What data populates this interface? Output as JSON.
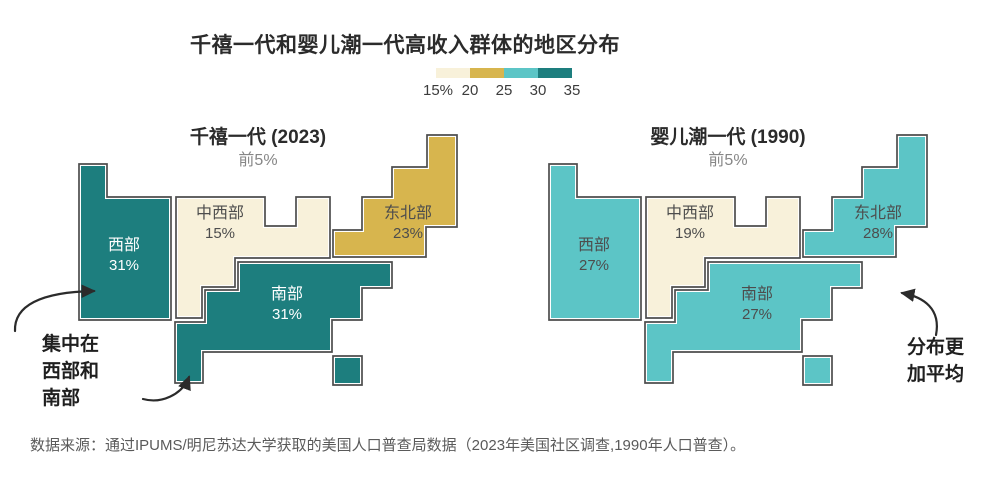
{
  "title": "千禧一代和婴儿潮一代高收入群体的地区分布",
  "colors": {
    "cream": "#f8f1da",
    "gold": "#d7b54e",
    "teal_light": "#5cc5c6",
    "teal_dark": "#1d7e7e",
    "outline": "#4d4d4d"
  },
  "legend": {
    "tick_labels": [
      "15%",
      "20",
      "25",
      "30",
      "35"
    ],
    "colors": [
      "#f8f1da",
      "#d7b54e",
      "#5cc5c6",
      "#1d7e7e"
    ]
  },
  "panels": [
    {
      "title": "千禧一代 (2023)",
      "subtitle": "前5%",
      "regions": {
        "west": {
          "name": "西部",
          "value": "31%"
        },
        "midwest": {
          "name": "中西部",
          "value": "15%"
        },
        "northeast": {
          "name": "东北部",
          "value": "23%"
        },
        "south": {
          "name": "南部",
          "value": "31%"
        }
      },
      "region_colors": {
        "west": "#1d7e7e",
        "midwest": "#f8f1da",
        "northeast": "#d7b54e",
        "south": "#1d7e7e"
      }
    },
    {
      "title": "婴儿潮一代 (1990)",
      "subtitle": "前5%",
      "regions": {
        "west": {
          "name": "西部",
          "value": "27%"
        },
        "midwest": {
          "name": "中西部",
          "value": "19%"
        },
        "northeast": {
          "name": "东北部",
          "value": "28%"
        },
        "south": {
          "name": "南部",
          "value": "27%"
        }
      },
      "region_colors": {
        "west": "#5cc5c6",
        "midwest": "#f8f1da",
        "northeast": "#5cc5c6",
        "south": "#5cc5c6"
      }
    }
  ],
  "annotations": {
    "left": {
      "lines": [
        "集中在",
        "西部和",
        "南部"
      ]
    },
    "right": {
      "lines": [
        "分布更",
        "加平均"
      ]
    }
  },
  "source": "数据来源：通过IPUMS/明尼苏达大学获取的美国人口普查局数据（2023年美国社区调查,1990年人口普查）。",
  "chart_data": {
    "type": "choropleth",
    "subtype": "block-cartogram, two side-by-side US region maps",
    "unit": "%",
    "title": "千禧一代和婴儿潮一代高收入群体的地区分布",
    "color_scale": {
      "tick_labels": [
        "15%",
        "20",
        "25",
        "30",
        "35"
      ],
      "bins": [
        "15-20",
        "20-25",
        "25-30",
        "30-35"
      ],
      "bin_colors": [
        "#f8f1da",
        "#d7b54e",
        "#5cc5c6",
        "#1d7e7e"
      ],
      "legend_position": "top-right under title"
    },
    "categories": [
      "西部",
      "中西部",
      "东北部",
      "南部"
    ],
    "series": [
      {
        "name": "千禧一代 (2023) 前5%",
        "values": [
          31,
          15,
          23,
          31
        ]
      },
      {
        "name": "婴儿潮一代 (1990) 前5%",
        "values": [
          27,
          19,
          28,
          27
        ]
      }
    ],
    "annotations": [
      "集中在西部和南部",
      "分布更加平均"
    ]
  }
}
